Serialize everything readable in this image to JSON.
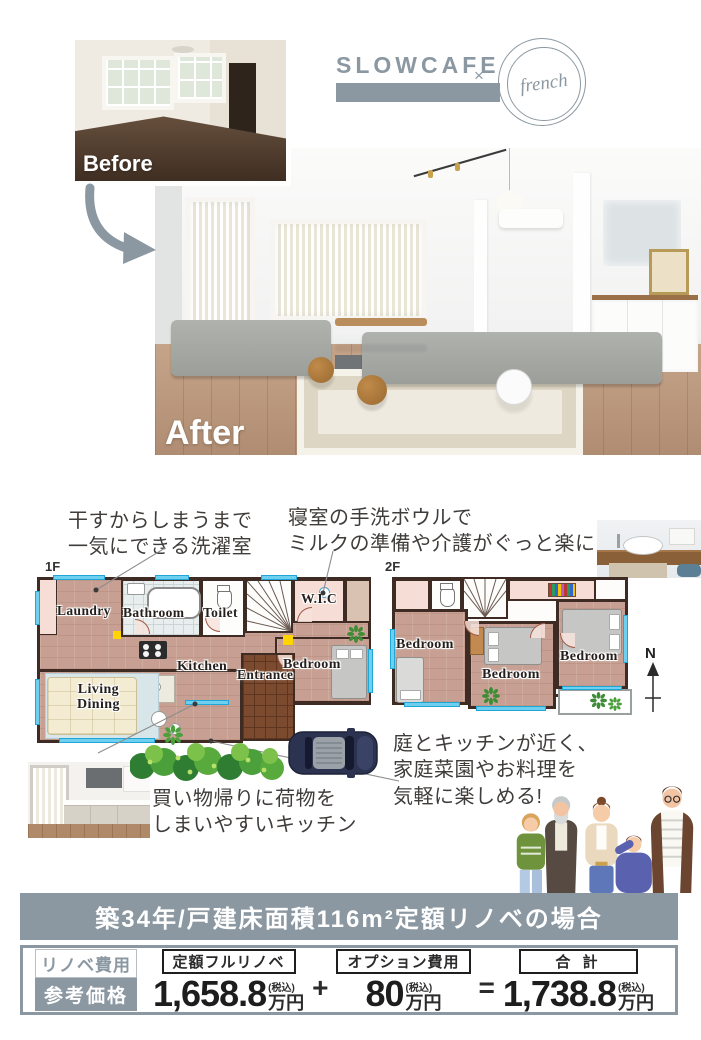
{
  "hero": {
    "before_label": "Before",
    "after_label": "After",
    "logo_brand": "SLOWCAFE",
    "logo_times": "×",
    "logo_stamp": "french"
  },
  "callouts": {
    "laundry": [
      "干すからしまうまで",
      "一気にできる洗濯室"
    ],
    "basin": [
      "寝室の手洗ボウルで",
      "ミルクの準備や介護がぐっと楽に!"
    ],
    "kitchen": [
      "買い物帰りに荷物を",
      "しまいやすいキッチン"
    ],
    "garden": [
      "庭とキッチンが近く、",
      "家庭菜園やお料理を",
      "気軽に楽しめる!"
    ]
  },
  "floorplans": {
    "f1_label": "1F",
    "f2_label": "2F",
    "compass": "N",
    "f1_rooms": {
      "laundry": "Laundry",
      "bathroom": "Bathroom",
      "toilet": "Toilet",
      "wic": "W.I.C",
      "bedroom": "Bedroom",
      "kitchen": "Kitchen",
      "entrance": "Entrance",
      "living_line1": "Living",
      "living_line2": "Dining"
    },
    "f2_rooms": [
      "Bedroom",
      "Bedroom",
      "Bedroom"
    ]
  },
  "pricing": {
    "band_title": "築34年/戸建床面積116m²定額リノベの場合",
    "side_label_top": "リノベ費用",
    "side_label_bottom": "参考価格",
    "items": [
      {
        "label": "定額フルリノベ",
        "value": "1,658.8",
        "tax_note": "(税込)",
        "unit": "万円"
      },
      {
        "label": "オプション費用",
        "value": "80",
        "tax_note": "(税込)",
        "unit": "万円"
      },
      {
        "label": "合 計",
        "value": "1,738.8",
        "tax_note": "(税込)",
        "unit": "万円"
      }
    ],
    "plus": "+",
    "equals": "="
  },
  "colors": {
    "accent": "#8b98a1",
    "plan_wall": "#3d2b24",
    "window_cyan": "#6ed0ee"
  }
}
